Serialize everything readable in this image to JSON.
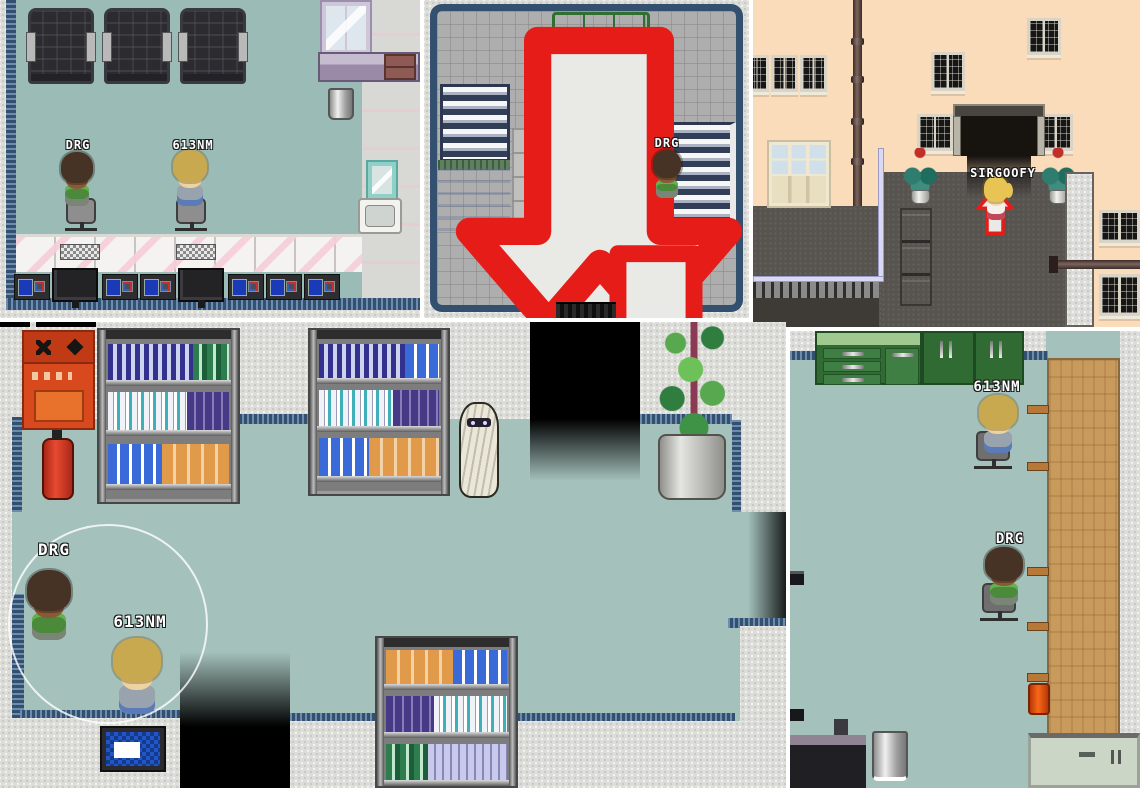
{
  "colors": {
    "floor_teal": "#9bbcb6",
    "floor_gray_grid": "#aeaeae",
    "wall_concrete": "#dcdcd9",
    "wall_peach": "#fbdcba",
    "border_navy": "#33506e",
    "arrow_red": "#e61c18",
    "arrow_fill": "#e9e9e6",
    "label_text": "#ffffff",
    "roof_dark": "#57534f"
  },
  "panels": {
    "salon": {
      "players": [
        {
          "name": "DRG"
        },
        {
          "name": "613NM"
        }
      ]
    },
    "lobby": {
      "players": [
        {
          "name": "DRG"
        }
      ],
      "arrows": [
        "down",
        "up",
        "down"
      ]
    },
    "street": {
      "players": [
        {
          "name": "SIRGOOFY"
        }
      ],
      "arrows": [
        "up"
      ]
    },
    "shop": {
      "players": [
        {
          "name": "DRG"
        },
        {
          "name": "613NM"
        }
      ]
    },
    "office": {
      "players": [
        {
          "name": "613NM"
        },
        {
          "name": "DRG"
        }
      ]
    }
  }
}
